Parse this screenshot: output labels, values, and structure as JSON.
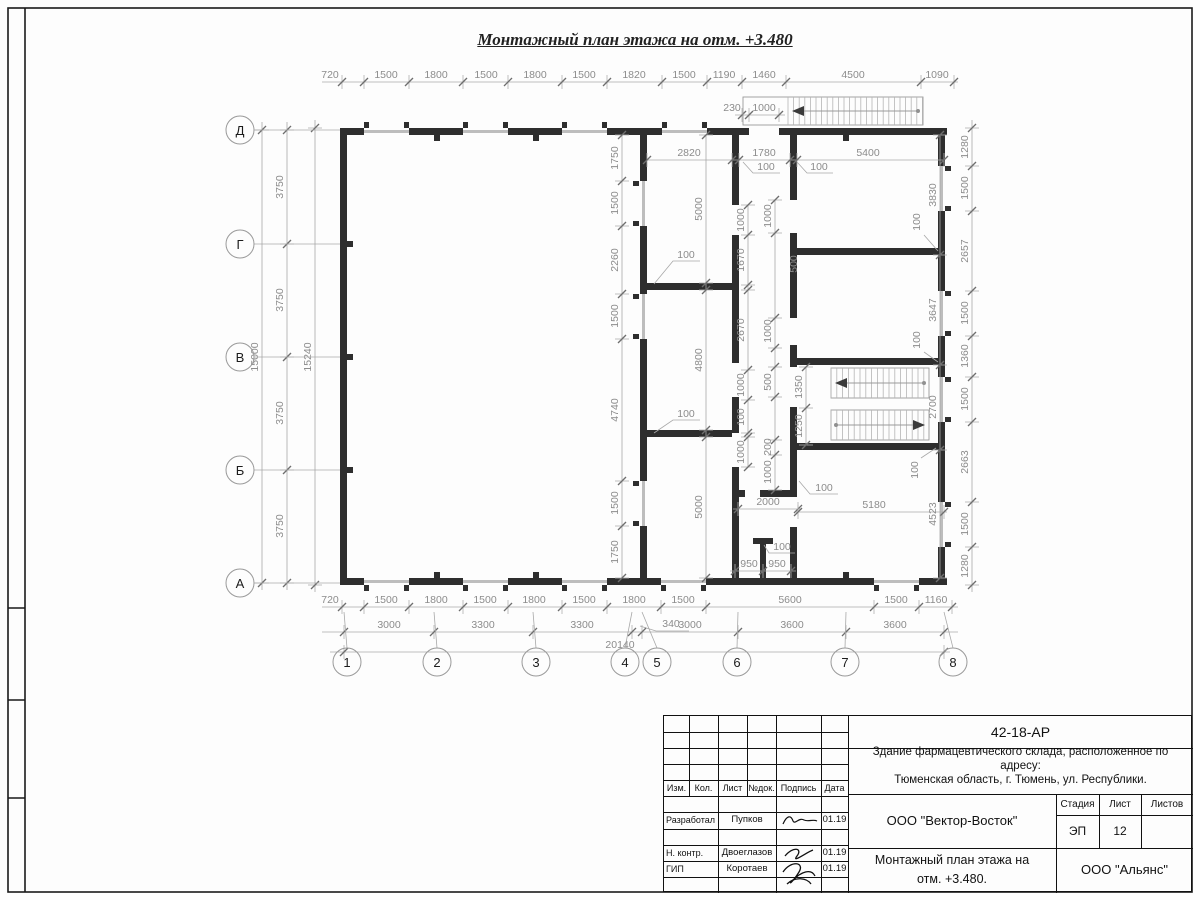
{
  "plan": {
    "title": "Монтажный план этажа на отм. +3.480",
    "dim_rows_h": [
      {
        "y": 82,
        "x1": 322,
        "x2": 958,
        "ticks": [
          342,
          364,
          409,
          463,
          508,
          562,
          607,
          662,
          707,
          742,
          786,
          921,
          954
        ],
        "labels": [
          {
            "t": "720",
            "x": 330
          },
          {
            "t": "1500",
            "x": 386
          },
          {
            "t": "1800",
            "x": 436
          },
          {
            "t": "1500",
            "x": 486
          },
          {
            "t": "1800",
            "x": 535
          },
          {
            "t": "1500",
            "x": 584
          },
          {
            "t": "1820",
            "x": 634
          },
          {
            "t": "1500",
            "x": 684
          },
          {
            "t": "1190",
            "x": 724
          },
          {
            "t": "1460",
            "x": 764
          },
          {
            "t": "4500",
            "x": 853
          },
          {
            "t": "1090",
            "x": 937
          }
        ]
      },
      {
        "y": 115,
        "x1": 735,
        "x2": 785,
        "ticks": [
          742,
          749,
          779
        ],
        "labels": [
          {
            "t": "230",
            "x": 732
          },
          {
            "t": "1000",
            "x": 764
          }
        ]
      },
      {
        "y": 160,
        "x1": 647,
        "x2": 944,
        "ticks": [
          647,
          732,
          739,
          790,
          797,
          944
        ],
        "labels": [
          {
            "t": "2820",
            "x": 689
          },
          {
            "t": "1780",
            "x": 764
          },
          {
            "t": "5400",
            "x": 868
          }
        ]
      },
      {
        "y": 607,
        "x1": 322,
        "x2": 958,
        "ticks": [
          342,
          364,
          409,
          463,
          508,
          562,
          607,
          661,
          706,
          874,
          919,
          952
        ],
        "labels": [
          {
            "t": "720",
            "x": 330
          },
          {
            "t": "1500",
            "x": 386
          },
          {
            "t": "1800",
            "x": 436
          },
          {
            "t": "1500",
            "x": 485
          },
          {
            "t": "1800",
            "x": 534
          },
          {
            "t": "1500",
            "x": 584
          },
          {
            "t": "1800",
            "x": 634
          },
          {
            "t": "1500",
            "x": 683
          },
          {
            "t": "5600",
            "x": 790
          },
          {
            "t": "1500",
            "x": 896
          },
          {
            "t": "1160",
            "x": 936
          }
        ]
      },
      {
        "y": 632,
        "x1": 322,
        "x2": 958,
        "ticks": [
          344,
          434,
          533,
          632,
          642,
          738,
          846,
          944
        ],
        "labels": [
          {
            "t": "3000",
            "x": 389
          },
          {
            "t": "3300",
            "x": 483
          },
          {
            "t": "3300",
            "x": 582
          },
          {
            "t": "3000",
            "x": 690
          },
          {
            "t": "3600",
            "x": 792
          },
          {
            "t": "3600",
            "x": 895
          }
        ]
      },
      {
        "y": 652,
        "x1": 330,
        "x2": 950,
        "ticks": [
          344,
          944
        ],
        "labels": [
          {
            "t": "20140",
            "x": 620
          }
        ]
      },
      {
        "y": 509,
        "x1": 733,
        "x2": 802,
        "ticks": [
          738,
          798
        ],
        "labels": [
          {
            "t": "2000",
            "x": 768
          }
        ]
      },
      {
        "y": 512,
        "x1": 796,
        "x2": 947,
        "ticks": [
          798,
          944
        ],
        "labels": [
          {
            "t": "5180",
            "x": 874
          }
        ]
      },
      {
        "y": 571,
        "x1": 730,
        "x2": 796,
        "ticks": [
          735,
          763,
          791
        ],
        "labels": [
          {
            "t": "950",
            "x": 749
          },
          {
            "t": "950",
            "x": 777
          }
        ]
      }
    ],
    "dim_rows_v": [
      {
        "x": 315,
        "y1": 120,
        "y2": 592,
        "ticks": [
          128,
          585
        ],
        "labels": [
          {
            "t": "15240",
            "y": 357
          }
        ]
      },
      {
        "x": 287,
        "y1": 122,
        "y2": 590,
        "ticks": [
          130,
          244,
          357,
          470,
          583
        ],
        "labels": [
          {
            "t": "3750",
            "y": 187
          },
          {
            "t": "3750",
            "y": 300
          },
          {
            "t": "3750",
            "y": 413
          },
          {
            "t": "3750",
            "y": 526
          }
        ]
      },
      {
        "x": 262,
        "y1": 122,
        "y2": 590,
        "ticks": [
          130,
          583
        ],
        "labels": [
          {
            "t": "15000",
            "y": 357
          }
        ]
      },
      {
        "x": 972,
        "y1": 120,
        "y2": 592,
        "ticks": [
          128,
          166,
          211,
          291,
          336,
          377,
          422,
          502,
          547,
          585
        ],
        "labels": [
          {
            "t": "1280",
            "y": 147
          },
          {
            "t": "1500",
            "y": 188
          },
          {
            "t": "2657",
            "y": 251
          },
          {
            "t": "1500",
            "y": 313
          },
          {
            "t": "1360",
            "y": 356
          },
          {
            "t": "1500",
            "y": 399
          },
          {
            "t": "2663",
            "y": 462
          },
          {
            "t": "1500",
            "y": 524
          },
          {
            "t": "1280",
            "y": 566
          }
        ]
      },
      {
        "x": 940,
        "y1": 135,
        "y2": 578,
        "ticks": [
          135,
          255,
          365,
          450,
          578
        ],
        "labels": [
          {
            "t": "3830",
            "y": 195
          },
          {
            "t": "3647",
            "y": 310
          },
          {
            "t": "2700",
            "y": 407
          },
          {
            "t": "4523",
            "y": 514
          }
        ]
      },
      {
        "x": 622,
        "y1": 135,
        "y2": 578,
        "ticks": [
          135,
          181,
          226,
          294,
          339,
          481,
          526,
          578
        ],
        "labels": [
          {
            "t": "1750",
            "y": 158
          },
          {
            "t": "1500",
            "y": 203
          },
          {
            "t": "2260",
            "y": 260
          },
          {
            "t": "1500",
            "y": 316
          },
          {
            "t": "4740",
            "y": 410
          },
          {
            "t": "1500",
            "y": 503
          },
          {
            "t": "1750",
            "y": 552
          }
        ]
      },
      {
        "x": 706,
        "y1": 135,
        "y2": 578,
        "ticks": [
          135,
          283,
          290,
          430,
          437,
          578
        ],
        "labels": [
          {
            "t": "5000",
            "y": 209
          },
          {
            "t": "4800",
            "y": 360
          },
          {
            "t": "5000",
            "y": 507
          }
        ]
      },
      {
        "x": 748,
        "y1": 205,
        "y2": 467,
        "ticks": [
          205,
          235,
          285,
          290,
          370,
          400,
          433,
          437,
          467
        ],
        "labels": [
          {
            "t": "1000",
            "y": 220
          },
          {
            "t": "1670",
            "y": 260
          },
          {
            "t": "2670",
            "y": 330
          },
          {
            "t": "1000",
            "y": 385
          },
          {
            "t": "100",
            "y": 417
          },
          {
            "t": "1000",
            "y": 452
          }
        ]
      },
      {
        "x": 775,
        "y1": 200,
        "y2": 490,
        "ticks": [
          200,
          233,
          318,
          348,
          367,
          397,
          440,
          455,
          490
        ],
        "labels": [
          {
            "t": "1000",
            "y": 216
          },
          {
            "t": "1000",
            "y": 331
          },
          {
            "t": "500",
            "y": 382
          },
          {
            "t": "200",
            "y": 447
          },
          {
            "t": "1000",
            "y": 472
          }
        ]
      },
      {
        "x": 806,
        "y1": 367,
        "y2": 445,
        "ticks": [
          367,
          408,
          445
        ],
        "labels": [
          {
            "t": "1350",
            "y": 387
          },
          {
            "t": "1250",
            "y": 426
          }
        ]
      }
    ],
    "free_labels": [
      {
        "t": "100",
        "x": 766,
        "y": 170,
        "r": 0
      },
      {
        "t": "100",
        "x": 819,
        "y": 170,
        "r": 0
      },
      {
        "t": "100",
        "x": 686,
        "y": 258,
        "r": 0
      },
      {
        "t": "100",
        "x": 686,
        "y": 417,
        "r": 0
      },
      {
        "t": "100",
        "x": 824,
        "y": 491,
        "r": 0
      },
      {
        "t": "100",
        "x": 782,
        "y": 550,
        "r": 0
      },
      {
        "t": "340",
        "x": 671,
        "y": 627,
        "r": 0
      },
      {
        "t": "100",
        "x": 920,
        "y": 222,
        "r": -90
      },
      {
        "t": "100",
        "x": 920,
        "y": 340,
        "r": -90
      },
      {
        "t": "100",
        "x": 918,
        "y": 470,
        "r": -90
      },
      {
        "t": "500",
        "x": 797,
        "y": 264,
        "r": -90
      }
    ],
    "axes_rows": [
      {
        "n": "Д",
        "y": 130
      },
      {
        "n": "Г",
        "y": 244
      },
      {
        "n": "В",
        "y": 357
      },
      {
        "n": "Б",
        "y": 470
      },
      {
        "n": "А",
        "y": 583
      }
    ],
    "axes_cols": [
      {
        "n": "1",
        "x": 347,
        "tx": 344
      },
      {
        "n": "2",
        "x": 437,
        "tx": 434
      },
      {
        "n": "3",
        "x": 536,
        "tx": 533
      },
      {
        "n": "4",
        "x": 625,
        "tx": 632
      },
      {
        "n": "5",
        "x": 657,
        "tx": 642
      },
      {
        "n": "6",
        "x": 737,
        "tx": 738
      },
      {
        "n": "7",
        "x": 845,
        "tx": 846
      },
      {
        "n": "8",
        "x": 953,
        "tx": 944
      }
    ],
    "stairs": [
      {
        "rx1": 743,
        "x1": 788,
        "x2": 923,
        "y1": 97,
        "y2": 125,
        "step": 5.6,
        "arrow": "left"
      },
      {
        "x1": 831,
        "x2": 929,
        "y1": 368,
        "y2": 398,
        "step": 5.8,
        "arrow": "left"
      },
      {
        "x1": 831,
        "x2": 929,
        "y1": 410,
        "y2": 440,
        "step": 5.8,
        "arrow": "right"
      }
    ]
  },
  "titleblock": {
    "doc_number": "42-18-АР",
    "project_line1": "Здание фармацевтического склада, расположенное по адресу:",
    "project_line2": "Тюменская область, г. Тюмень, ул. Республики.",
    "org": "ООО \"Вектор-Восток\"",
    "stage_label": "Стадия",
    "sheet_label": "Лист",
    "sheets_label": "Листов",
    "stage": "ЭП",
    "sheet_no": "12",
    "sheets_total": "",
    "drawing_title_line1": "Монтажный план этажа на",
    "drawing_title_line2": "отм. +3.480.",
    "company": "ООО \"Альянс\"",
    "header": {
      "izm": "Изм.",
      "kol": "Кол.",
      "list": "Лист",
      "ndoc": "№док.",
      "sign": "Подпись",
      "date": "Дата"
    },
    "roles": [
      {
        "role": "Разработал",
        "name": "Пупков",
        "date": "01.19"
      },
      {
        "role": "Н. контр.",
        "name": "Двоеглазов",
        "date": "01.19"
      },
      {
        "role": "ГИП",
        "name": "Коротаев",
        "date": "01.19"
      }
    ]
  }
}
